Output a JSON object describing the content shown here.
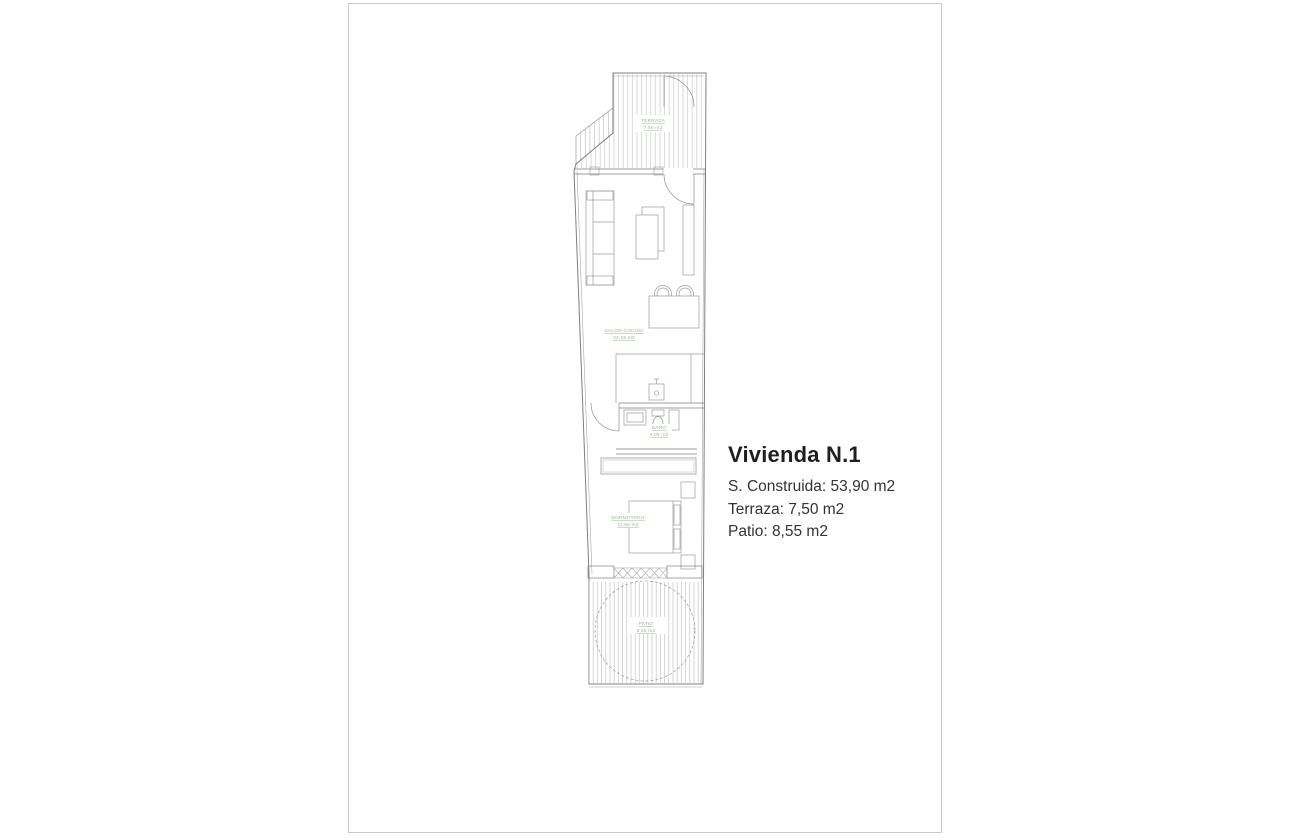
{
  "colors": {
    "label_green": "#93b88d",
    "wall_gray": "#7f7f7f",
    "furniture_gray": "#9a9a9a",
    "hatch_gray": "#c9c9c9",
    "card_border": "#c9c9c9",
    "title_text": "#1f1f1f",
    "body_text": "#333333"
  },
  "info": {
    "title": "Vivienda N.1",
    "construida": "S. Construida: 53,90 m2",
    "terraza": "Terraza: 7,50 m2",
    "patio": "Patio: 8,55 m2"
  },
  "floorplan": {
    "rooms": [
      {
        "name": "TERRAZA",
        "area": "7,50 m2"
      },
      {
        "name": "SALON-COCINA",
        "area": "22,15 m2"
      },
      {
        "name": "BAÑO",
        "area": "4,05 m2"
      },
      {
        "name": "DORMITORIO",
        "area": "11,95 m2"
      },
      {
        "name": "PATIO",
        "area": "8,55 m2"
      }
    ]
  }
}
